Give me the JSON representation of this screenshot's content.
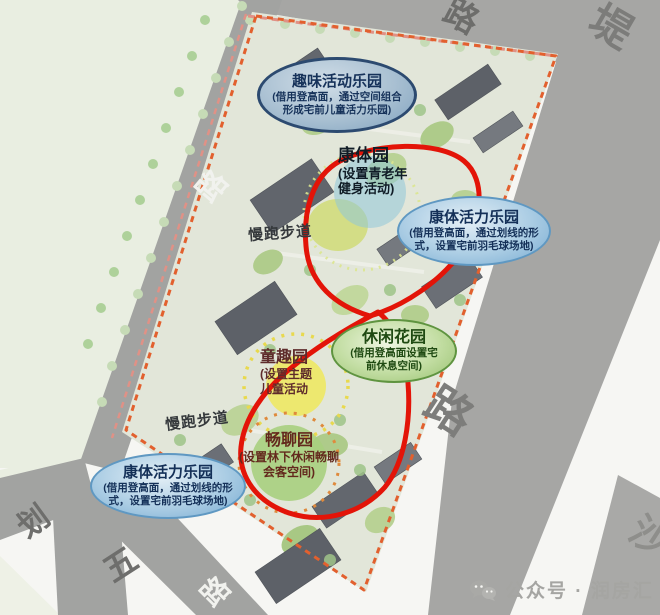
{
  "legend_bubbles": {
    "fun_activity": {
      "title": "趣味活动乐园",
      "line1": "(借用登高面，通过空间组合",
      "line2": "形成宅前儿童活力乐园)"
    },
    "fitness_vitality_right": {
      "title": "康体活力乐园",
      "line1": "(借用登高面，通过划线的形",
      "line2": "式，设置宅前羽毛球场地)"
    },
    "leisure_garden": {
      "title": "休闲花园",
      "line1": "(借用登高面设置宅",
      "line2": "前休息空间)"
    },
    "fitness_vitality_left": {
      "title": "康体活力乐园",
      "line1": "(借用登高面，通过划线的形",
      "line2": "式，设置宅前羽毛球场地)"
    }
  },
  "spot_labels": {
    "fitness_park": {
      "title": "康体园",
      "line1": "(设置青老年",
      "line2": "健身活动)"
    },
    "kids_park": {
      "title": "童趣园",
      "line1": "(设置主题",
      "line2": "儿童活动"
    },
    "chat_garden": {
      "title": "畅聊园",
      "line1": "(设置林下休闲畅聊",
      "line2": "会客空间)"
    }
  },
  "path_labels": {
    "jogging_top": "慢跑步道",
    "jogging_bottom": "慢跑步道"
  },
  "road_labels": {
    "top_road": "路",
    "dike": "堤",
    "left_road": "路",
    "right_road": "路",
    "hua": "划",
    "wu": "五",
    "bottom_road": "路",
    "sha": "沙"
  },
  "watermark": {
    "source": "公众号 · 润房汇"
  },
  "colors": {
    "loop_red": "#e31408",
    "boundary_orange": "#e2602e",
    "road_gray": "#a6a6a4",
    "field_green": "#e9eee1",
    "site_base": "#e2e6d9"
  }
}
